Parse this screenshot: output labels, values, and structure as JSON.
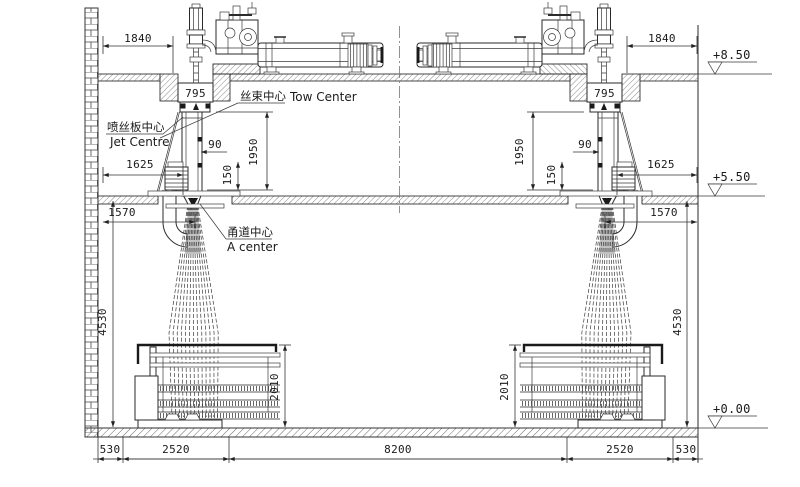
{
  "drawing": {
    "labels": {
      "tow_center_cn": "丝束中心",
      "tow_center_en": "Tow Center",
      "jet_center_cn": "喷丝板中心",
      "jet_center_en": "Jet Centre",
      "a_center_cn": "甬道中心",
      "a_center_en": "A center"
    },
    "elevations": {
      "roof": "+8.50",
      "mezzanine": "+5.50",
      "ground": "+0.00"
    },
    "dims": {
      "d1840": "1840",
      "d795": "795",
      "d90": "90",
      "d1950": "1950",
      "d150": "150",
      "d1625": "1625",
      "d1570": "1570",
      "d4530": "4530",
      "d2010": "2010",
      "d530": "530",
      "d2520": "2520",
      "d8200": "8200"
    },
    "colors": {
      "line": "#2a2a2a",
      "hatch": "#555555",
      "background": "#ffffff"
    }
  }
}
